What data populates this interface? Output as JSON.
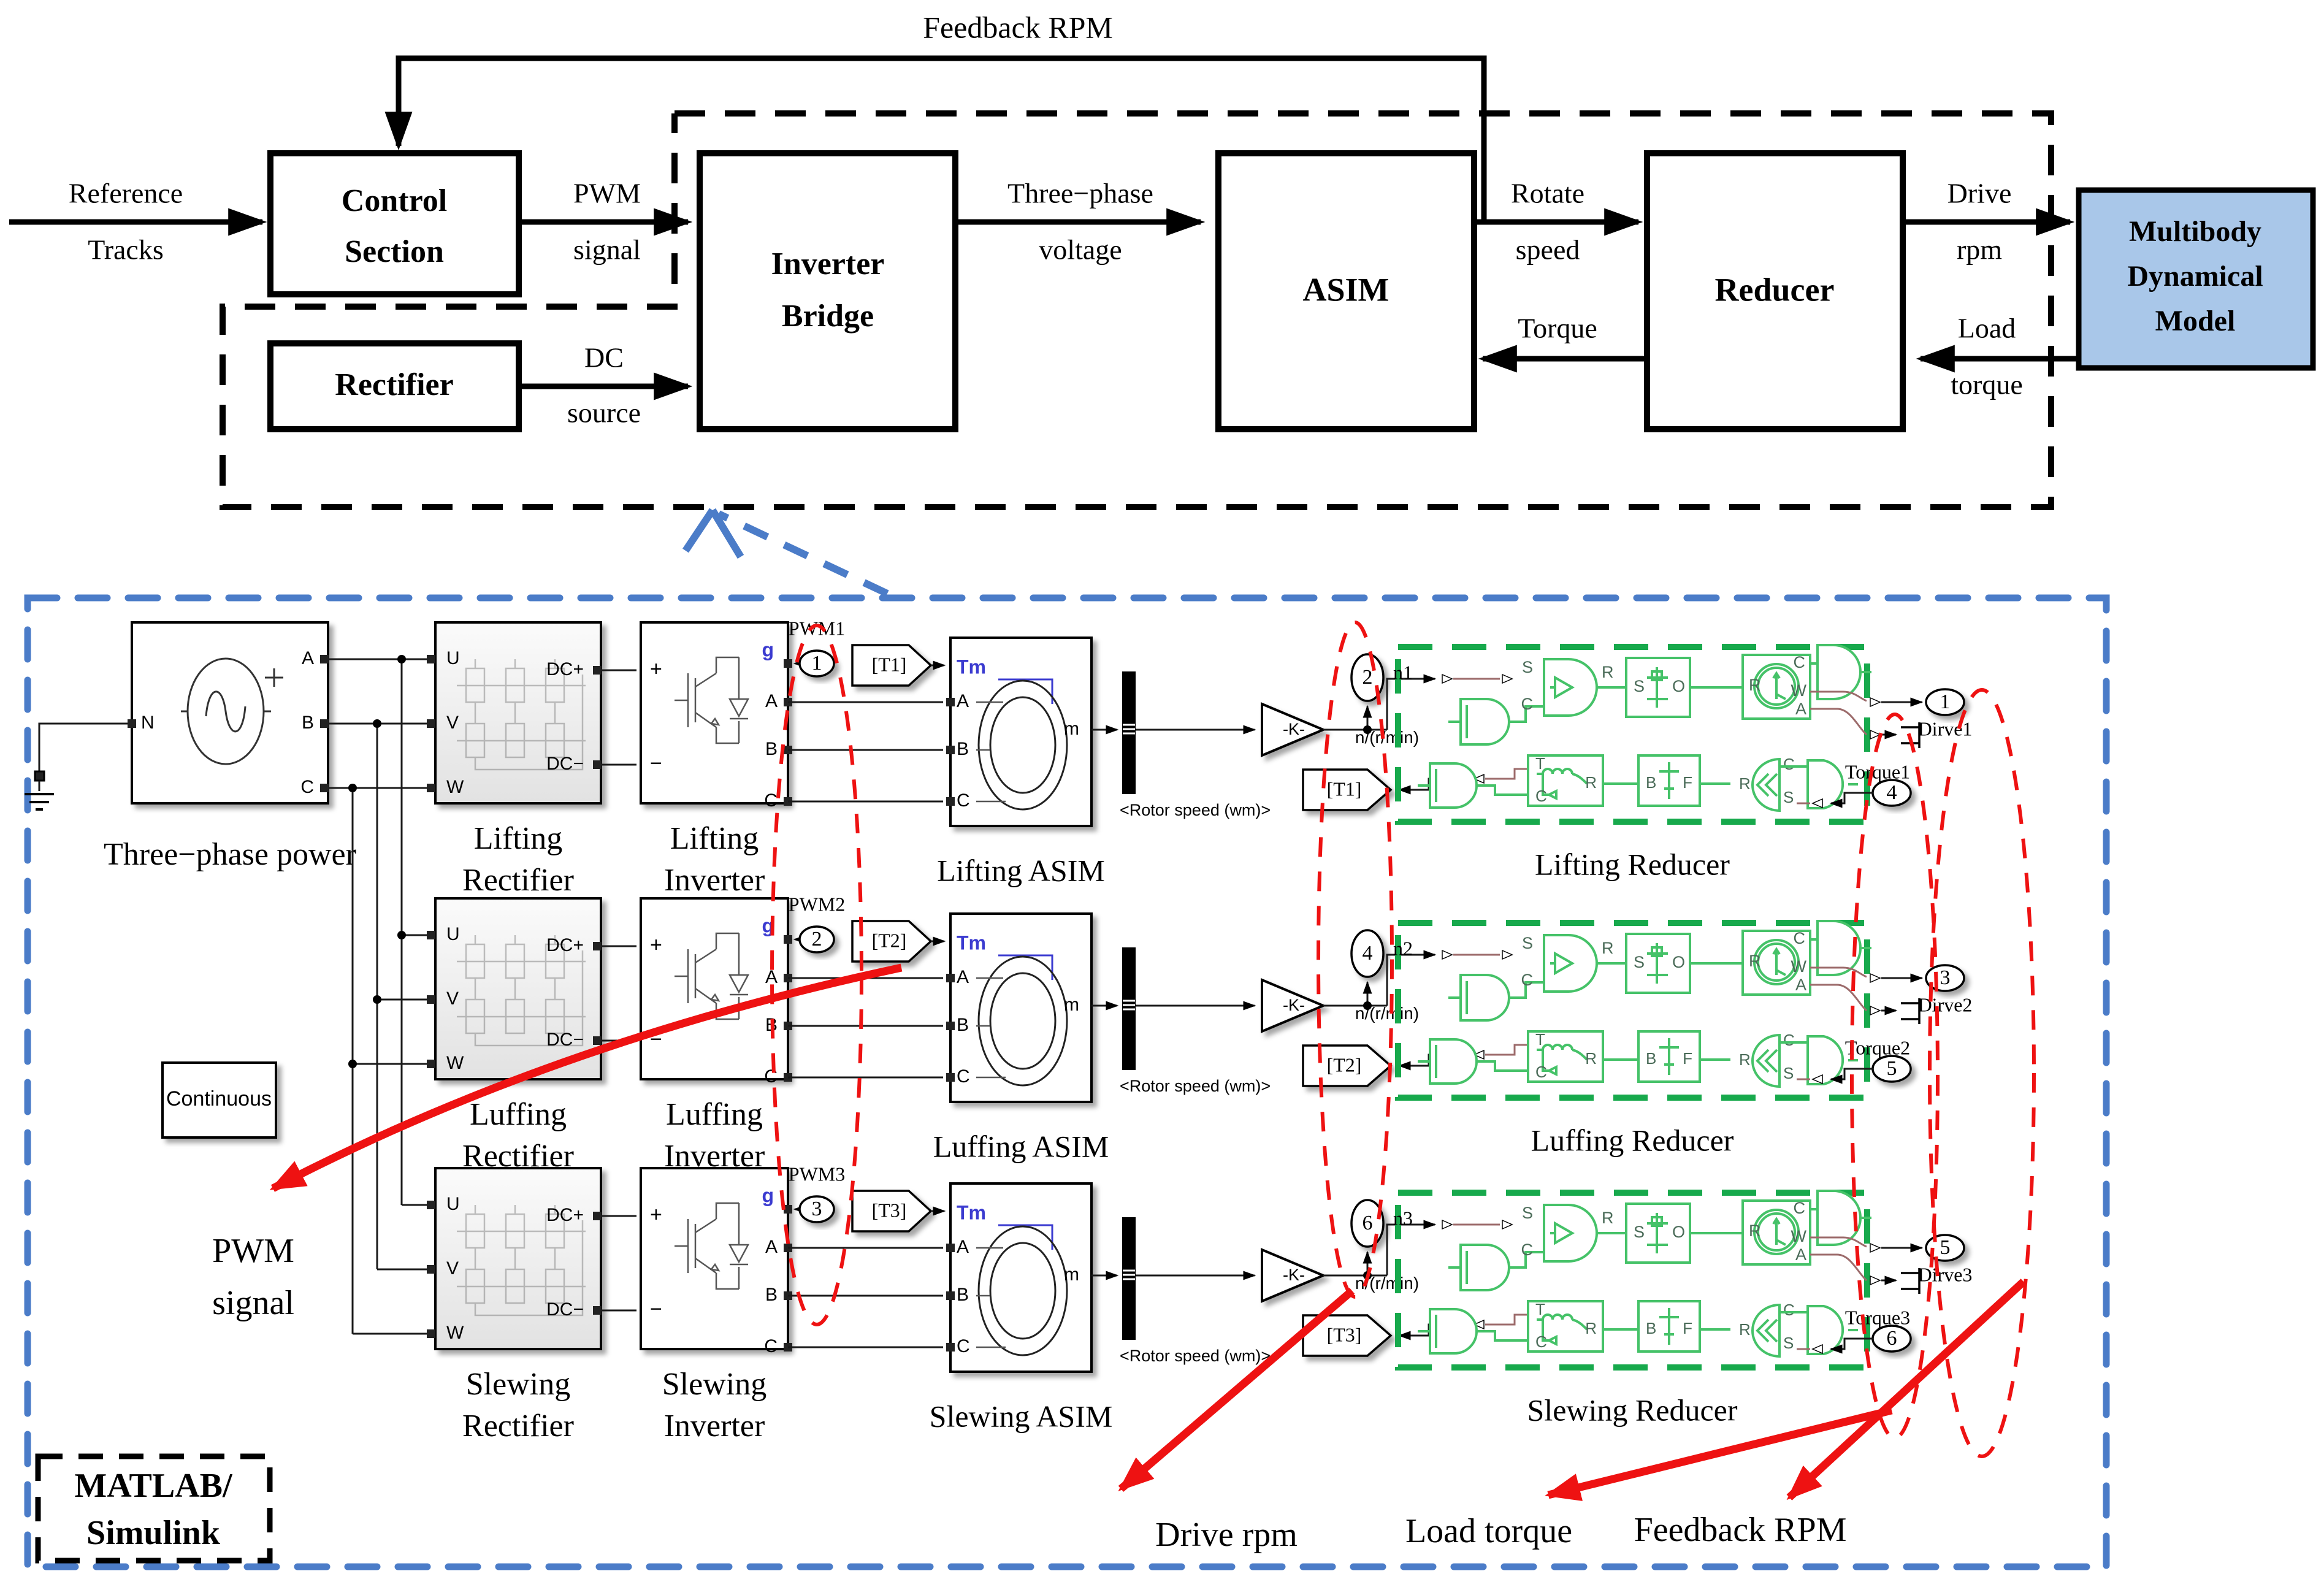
{
  "top": {
    "feedback_rpm": "Feedback RPM",
    "reference": [
      "Reference",
      "Tracks"
    ],
    "control": [
      "Control",
      "Section"
    ],
    "pwm": [
      "PWM",
      "signal"
    ],
    "rectifier": "Rectifier",
    "dc": [
      "DC",
      "source"
    ],
    "inverter": [
      "Inverter",
      "Bridge"
    ],
    "voltage": [
      "Three−phase",
      "voltage"
    ],
    "asim": "ASIM",
    "rotate": [
      "Rotate",
      "speed"
    ],
    "torque": "Torque",
    "reducer": "Reducer",
    "drive": [
      "Drive",
      "rpm"
    ],
    "load": [
      "Load",
      "torque"
    ],
    "multibody": [
      "Multibody",
      "Dynamical",
      "Model"
    ]
  },
  "sim": {
    "source_label": "Three−phase power",
    "ports": {
      "n": "N",
      "a": "A",
      "b": "B",
      "c": "C",
      "u": "U",
      "v": "V",
      "w": "W",
      "dcp": "DC+",
      "dcm": "DC−",
      "g": "g",
      "plus": "+",
      "minus": "−",
      "tm": "Tm",
      "m": "m"
    },
    "gain": "-K-",
    "n_unit": "n/(r/min)",
    "rotor": "<Rotor speed (wm)>",
    "rp": {
      "s": "S",
      "r": "R",
      "c": "C",
      "o": "O",
      "w": "W",
      "a": "A",
      "t": "T",
      "b": "B",
      "f": "F"
    },
    "continuous": "Continuous",
    "pwm_label": [
      "PWM",
      "signal"
    ],
    "matlab": [
      "MATLAB/",
      "Simulink"
    ],
    "bottom": {
      "drive": "Drive rpm",
      "load": "Load torque",
      "feedback": "Feedback RPM"
    },
    "rows": [
      {
        "pwm": "PWM1",
        "pwm_n": "1",
        "tag": "[T1]",
        "n_n": "2",
        "n": "n1",
        "asim": "Lifting ASIM",
        "reducer": "Lifting Reducer",
        "rect1": "Lifting",
        "rect2": "Rectifier",
        "inv1": "Lifting",
        "inv2": "Inverter",
        "drive_n": "1",
        "drive": "Dirve1",
        "torque_n": "4",
        "torque": "Torque1"
      },
      {
        "pwm": "PWM2",
        "pwm_n": "2",
        "tag": "[T2]",
        "n_n": "4",
        "n": "n2",
        "asim": "Luffing ASIM",
        "reducer": "Luffing Reducer",
        "rect1": "Luffing",
        "rect2": "Rectifier",
        "inv1": "Luffing",
        "inv2": "Inverter",
        "drive_n": "3",
        "drive": "Dirve2",
        "torque_n": "5",
        "torque": "Torque2"
      },
      {
        "pwm": "PWM3",
        "pwm_n": "3",
        "tag": "[T3]",
        "n_n": "6",
        "n": "n3",
        "asim": "Slewing ASIM",
        "reducer": "Slewing Reducer",
        "rect1": "Slewing",
        "rect2": "Rectifier",
        "inv1": "Slewing",
        "inv2": "Inverter",
        "drive_n": "5",
        "drive": "Dirve3",
        "torque_n": "6",
        "torque": "Torque3"
      }
    ]
  }
}
